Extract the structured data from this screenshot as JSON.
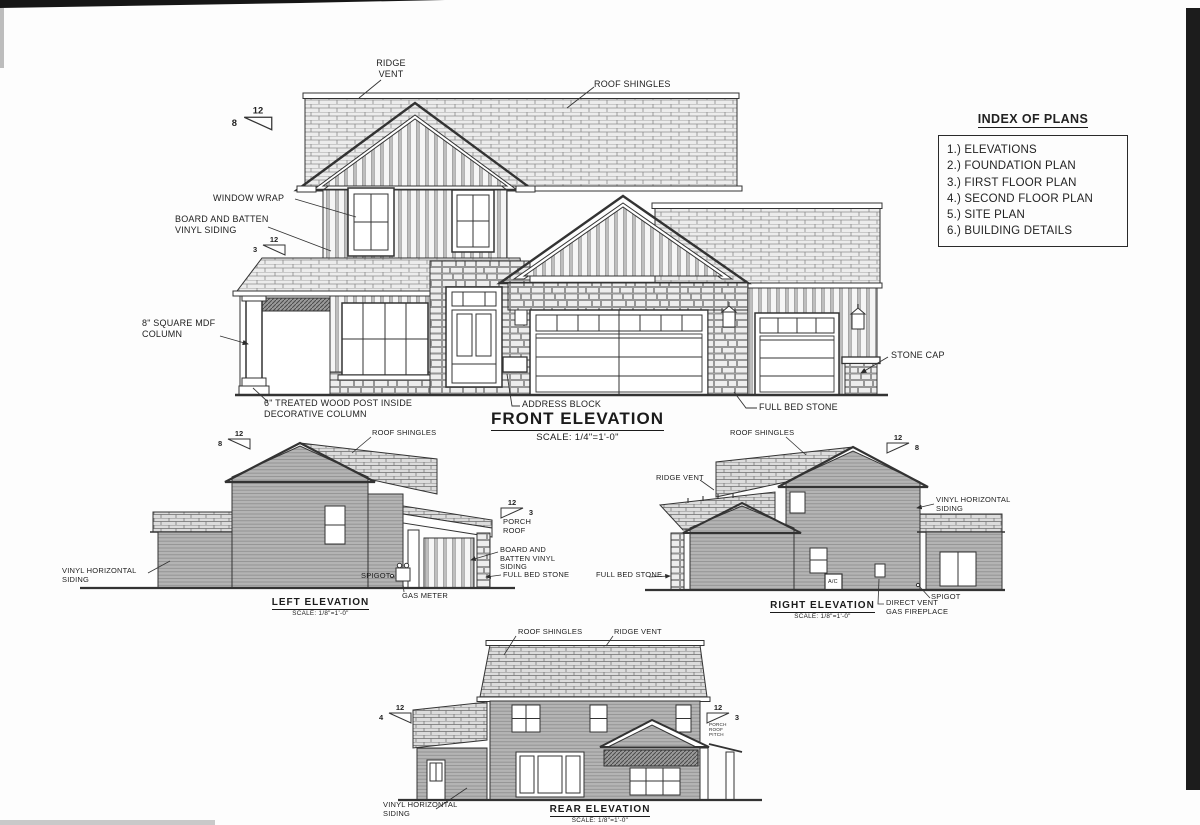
{
  "index": {
    "title": "INDEX OF PLANS",
    "items": [
      "1.) ELEVATIONS",
      "2.) FOUNDATION PLAN",
      "3.) FIRST FLOOR PLAN",
      "4.) SECOND FLOOR PLAN",
      "5.) SITE PLAN",
      "6.) BUILDING DETAILS"
    ]
  },
  "front": {
    "title": "FRONT ELEVATION",
    "scale": "SCALE: 1/4\"=1'-0\"",
    "labels": {
      "ridge_vent": "RIDGE VENT",
      "roof_shingles": "ROOF SHINGLES",
      "window_wrap": "WINDOW WRAP",
      "board_batten": "BOARD AND BATTEN VINYL SIDING",
      "mdf_column": "8\" SQUARE MDF COLUMN",
      "wood_post": "6\" TREATED WOOD POST INSIDE DECORATIVE COLUMN",
      "address_block": "ADDRESS BLOCK",
      "full_bed_stone": "FULL BED STONE",
      "stone_cap": "STONE CAP"
    },
    "pitch_main": {
      "rise": "8",
      "run": "12"
    },
    "pitch_porch": {
      "rise": "3",
      "run": "12"
    }
  },
  "left": {
    "title": "LEFT ELEVATION",
    "scale": "SCALE: 1/8\"=1'-0\"",
    "labels": {
      "roof_shingles": "ROOF SHINGLES",
      "vinyl_siding": "VINYL HORIZONTAL SIDING",
      "spigot": "SPIGOT",
      "gas_meter": "GAS METER",
      "porch_roof": "PORCH ROOF",
      "board_batten": "BOARD AND BATTEN VINYL SIDING",
      "full_bed_stone": "FULL BED STONE"
    },
    "pitch_main": {
      "rise": "8",
      "run": "12"
    },
    "pitch_porch": {
      "rise": "3",
      "run": "12"
    }
  },
  "right": {
    "title": "RIGHT ELEVATION",
    "scale": "SCALE: 1/8\"=1'-0\"",
    "labels": {
      "roof_shingles": "ROOF SHINGLES",
      "ridge_vent": "RIDGE VENT",
      "vinyl_siding": "VINYL HORIZONTAL SIDING",
      "full_bed_stone": "FULL BED STONE",
      "ac": "A/C",
      "direct_vent": "DIRECT VENT GAS FIREPLACE",
      "spigot": "SPIGOT"
    },
    "pitch_main": {
      "rise": "8",
      "run": "12"
    }
  },
  "rear": {
    "title": "REAR ELEVATION",
    "scale": "SCALE: 1/8\"=1'-0\"",
    "labels": {
      "roof_shingles": "ROOF SHINGLES",
      "ridge_vent": "RIDGE VENT",
      "vinyl_siding": "VINYL HORIZONTAL SIDING",
      "porch_pitch_note": "PORCH ROOF PITCH"
    },
    "pitch_left": {
      "rise": "4",
      "run": "12"
    },
    "pitch_porch": {
      "rise": "3",
      "run": "12"
    }
  }
}
